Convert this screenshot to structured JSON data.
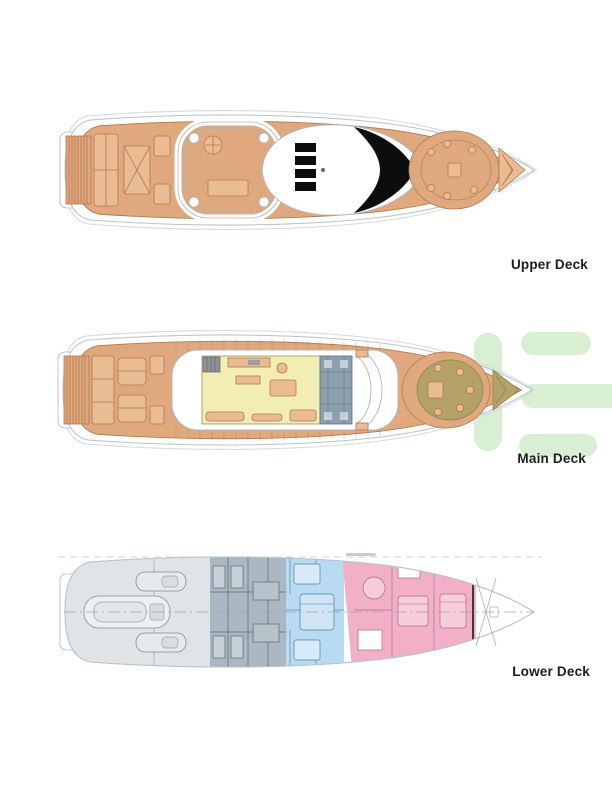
{
  "page": {
    "background": "#ffffff",
    "kind": "yacht-deck-plan-sheet"
  },
  "decks": [
    {
      "id": "upper-deck",
      "label": "Upper Deck"
    },
    {
      "id": "main-deck",
      "label": "Main Deck"
    },
    {
      "id": "lower-deck",
      "label": "Lower Deck"
    }
  ],
  "lower_deck_zones": [
    {
      "name": "tender-garage",
      "color": "#e0e4e7"
    },
    {
      "name": "crew-area",
      "color": "#a9b8c2"
    },
    {
      "name": "guest-cabins",
      "color": "#b8dbf1"
    },
    {
      "name": "owner-guest-cabins",
      "color": "#f1b0c8"
    }
  ],
  "colors": {
    "deck-tan": "#dfa87e",
    "deck-tan-light": "#e9bc93",
    "deck-tan-line": "#b5794c",
    "salon-yellow": "#f2edb2",
    "galley-slate": "#8b9fae",
    "bow-olive": "#b3a166",
    "glass-black": "#0d0d0d",
    "zone-gray": "#e0e4e7",
    "zone-crew": "#a9b8c2",
    "zone-blue": "#b8dbf1",
    "zone-pink": "#f1b0c8",
    "watermark-green": "#d9efd3",
    "label-text": "#1c1c1e",
    "hull-line": "#b9c2c8"
  },
  "watermark": {
    "name": "logo-letter-e-watermark"
  }
}
